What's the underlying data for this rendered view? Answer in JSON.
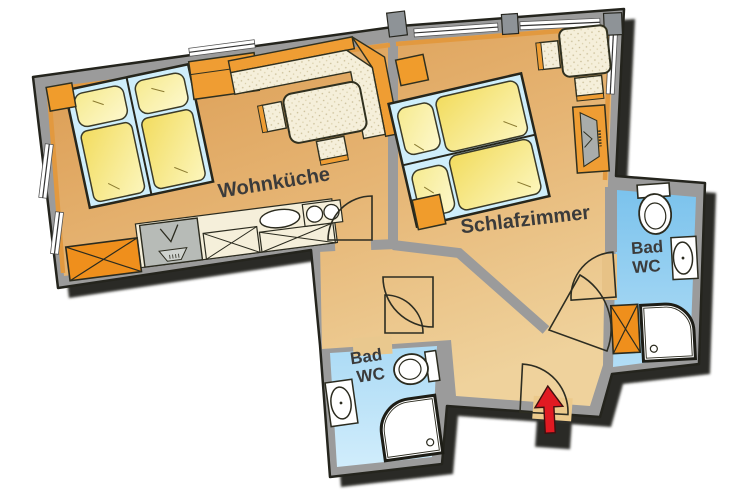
{
  "floorplan": {
    "rooms": {
      "living_kitchen": {
        "label": "Wohnküche"
      },
      "bedroom": {
        "label": "Schlafzimmer"
      },
      "bath_right": {
        "line1": "Bad",
        "line2": "WC"
      },
      "bath_left": {
        "line1": "Bad",
        "line2": "WC"
      }
    },
    "icons": [
      "double-bed-icon",
      "pillow-icon",
      "duvet-icon",
      "corner-bench-icon",
      "dining-table-icon",
      "stool-icon",
      "kitchen-sink-icon",
      "cooktop-icon",
      "kitchen-cabinet-icon",
      "wardrobe-icon",
      "desk-icon",
      "chair-icon",
      "tv-sideboard-icon",
      "toilet-icon",
      "washbasin-icon",
      "shower-icon",
      "door-swing-icon",
      "window-icon",
      "entrance-arrow-icon"
    ],
    "colors": {
      "wall_gray": "#9b9b9b",
      "outline_dark": "#24241d",
      "floor_main_dark": "#d9964a",
      "floor_main_light": "#efd29c",
      "floor_bath_dark": "#78c1ec",
      "floor_bath_light": "#d3eefc",
      "furniture_orange": "#ef941f",
      "furniture_cream": "#f5efda",
      "bed_background_blue": "#cfeefb",
      "bedding_yellow": "#f4e06a",
      "entrance_arrow_red": "#e11a22",
      "label_text": "#3b3b3b"
    }
  }
}
